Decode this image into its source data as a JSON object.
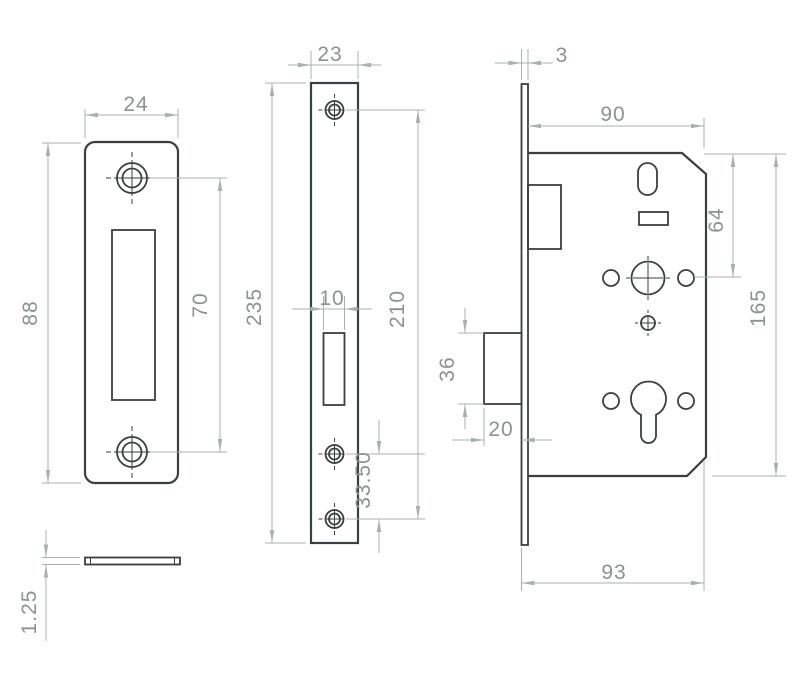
{
  "colors": {
    "outline": "#3a3f3f",
    "dimension_lines": "#a9b0b0",
    "dimension_text": "#8c9292",
    "background": "#ffffff"
  },
  "dims": {
    "strike": {
      "width": "24",
      "height": "88",
      "hole_spacing": "70",
      "thickness": "1.25"
    },
    "faceplate": {
      "width": "23",
      "height": "235",
      "hole_spacing": "210",
      "slot_width": "10",
      "bottom_hole_spacing": "33.50"
    },
    "body": {
      "faceplate_thickness": "3",
      "case_depth": "90",
      "case_height": "165",
      "top_to_spindle": "64",
      "deadbolt_height": "36",
      "deadbolt_throw": "20",
      "overall_depth": "93"
    }
  }
}
